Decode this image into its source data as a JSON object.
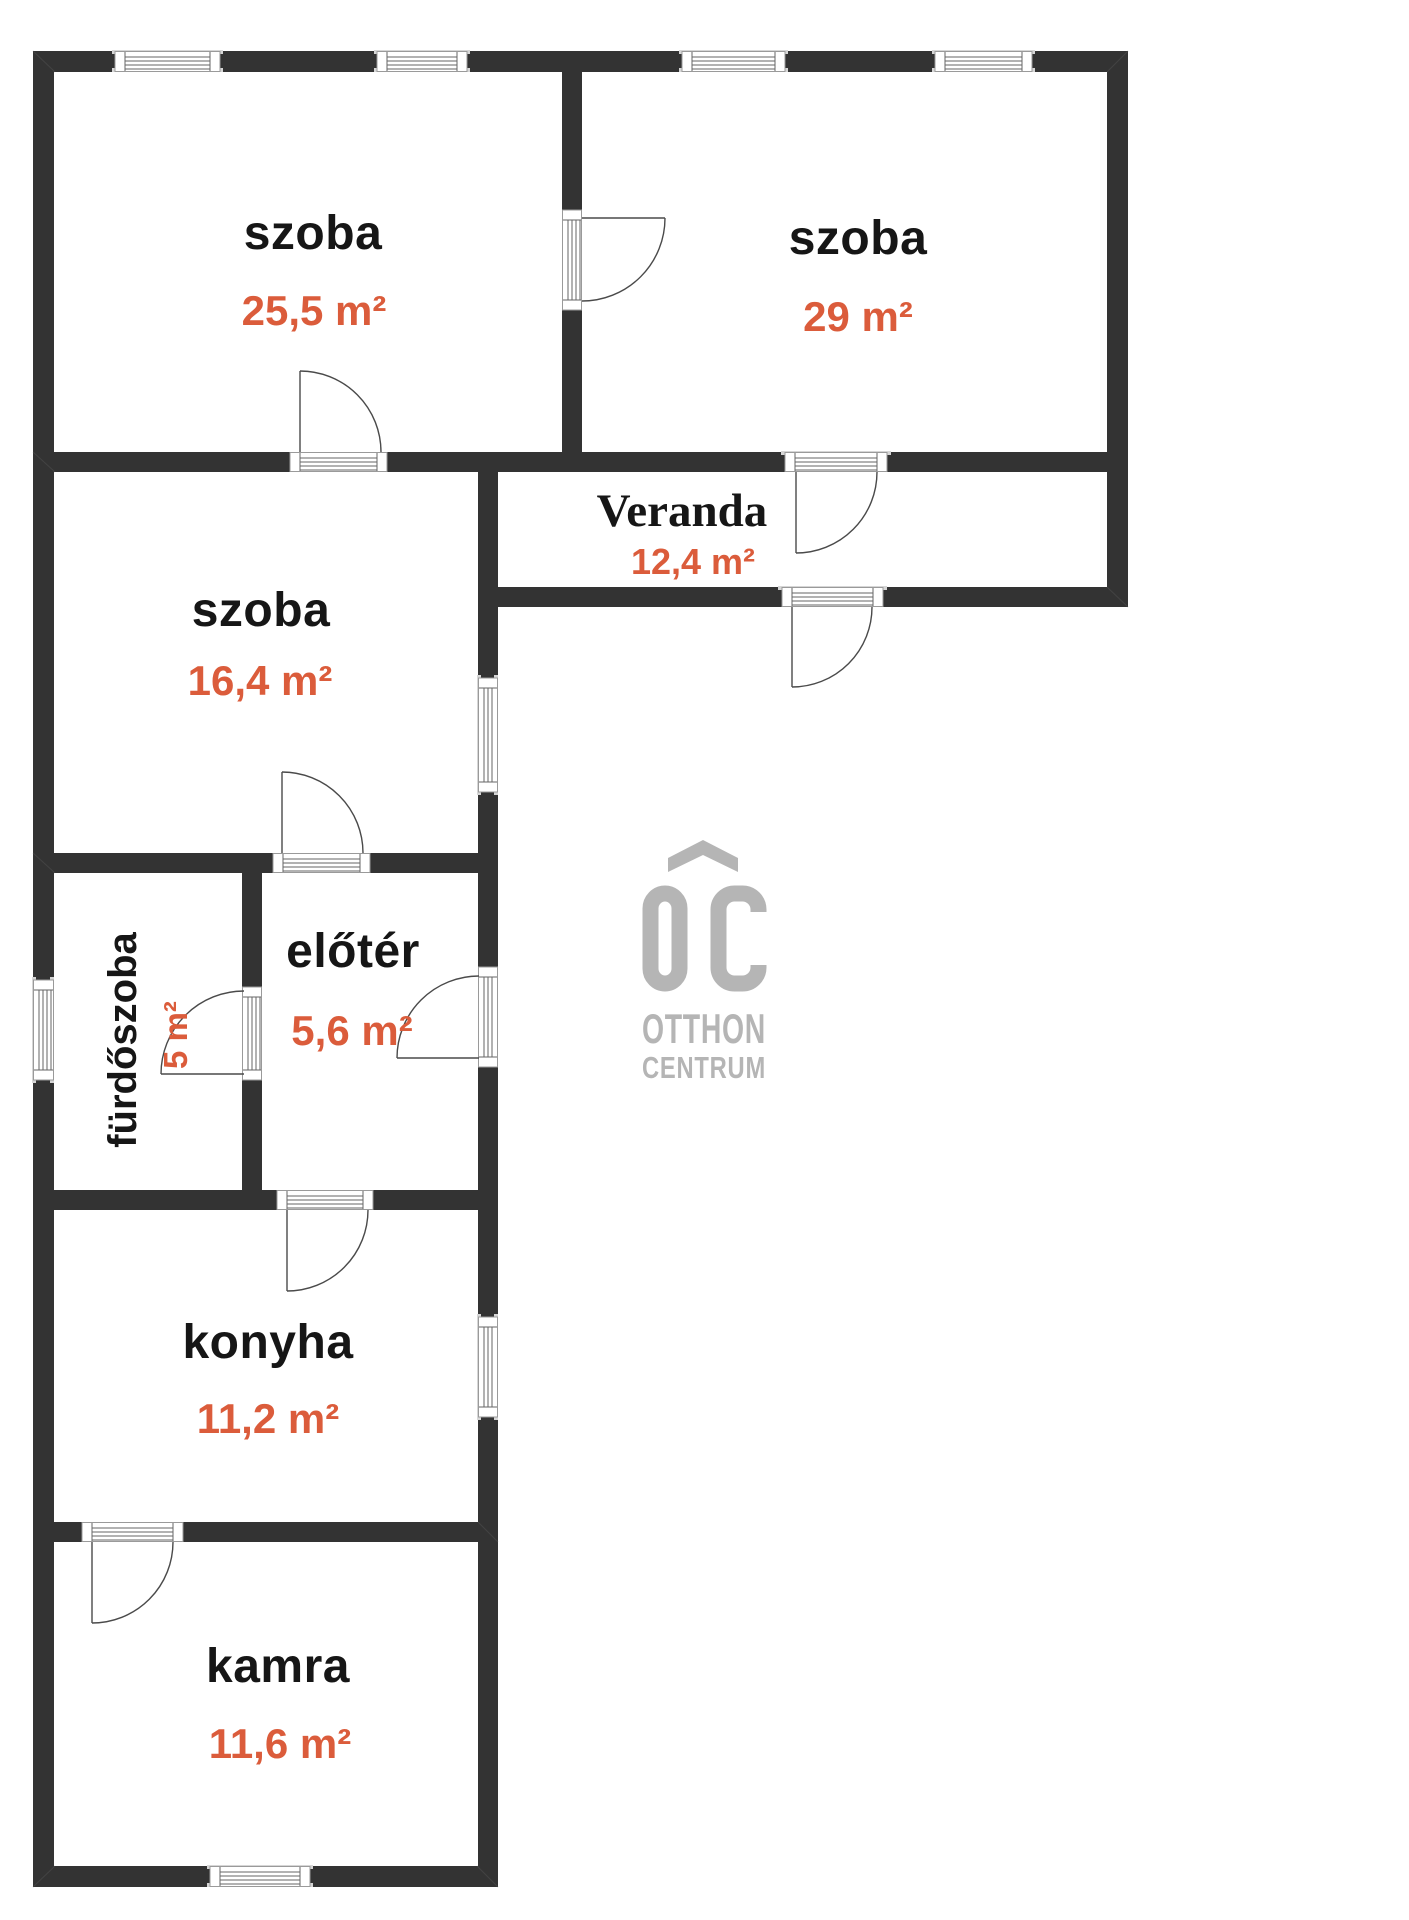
{
  "rooms": [
    {
      "name": "szoba",
      "area": "25,5 m²"
    },
    {
      "name": "szoba",
      "area": "29 m²"
    },
    {
      "name": "Veranda",
      "area": "12,4 m²"
    },
    {
      "name": "szoba",
      "area": "16,4 m²"
    },
    {
      "name": "fürdőszoba",
      "area": "5 m²"
    },
    {
      "name": "előtér",
      "area": "5,6 m²"
    },
    {
      "name": "konyha",
      "area": "11,2 m²"
    },
    {
      "name": "kamra",
      "area": "11,6 m²"
    }
  ],
  "logo": {
    "monogram": "OC",
    "line1": "OTTHON",
    "line2": "CENTRUM"
  },
  "colors": {
    "wall": "#333333",
    "label_text": "#161616",
    "area_text": "#DB5C3B",
    "logo_gray": "#B5B5B5"
  }
}
